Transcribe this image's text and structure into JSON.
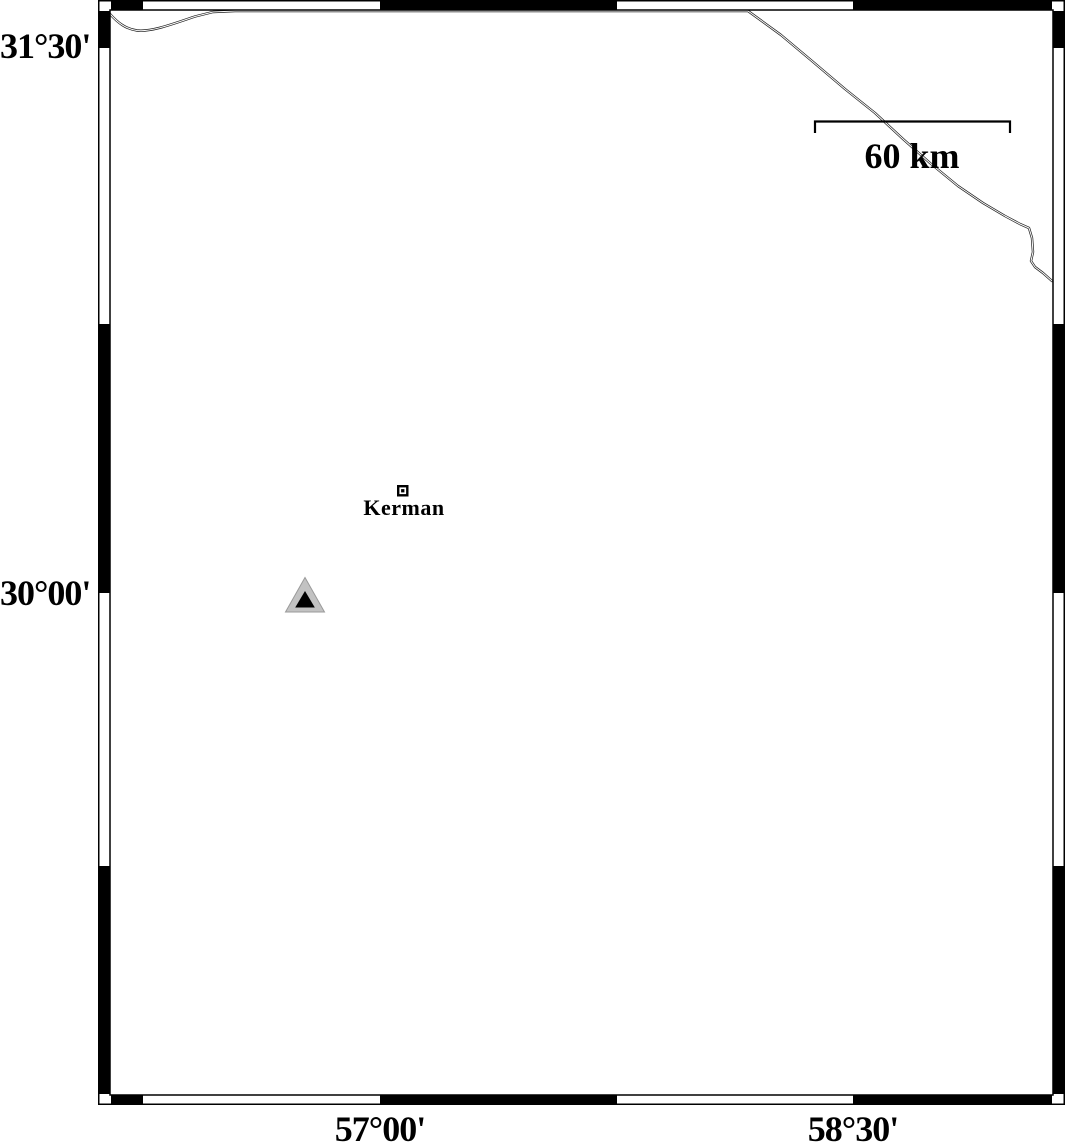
{
  "map": {
    "region": {
      "lat_tick_labels": [
        {
          "label": "31°30'"
        },
        {
          "label": "30°00'"
        }
      ],
      "lon_tick_labels": [
        {
          "label": "57°00'"
        },
        {
          "label": "58°30'"
        }
      ]
    },
    "scale_bar": {
      "label": "60 km"
    },
    "markers": [
      {
        "type": "city-square",
        "label": "Kerman"
      },
      {
        "type": "station-triangle",
        "label": ""
      }
    ],
    "colors": {
      "frame": "#000000",
      "background": "#ffffff",
      "station_fill": "#c2c2c2",
      "station_core": "#000000",
      "road_line": "#1f1f1f"
    }
  }
}
